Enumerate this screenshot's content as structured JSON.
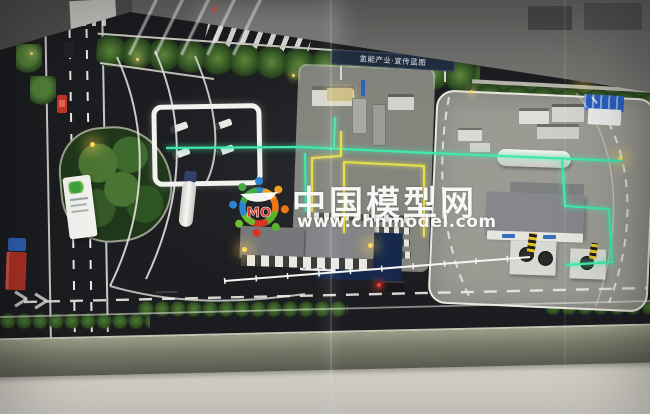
{
  "watermark": {
    "title": "中国模型网",
    "url": "www.chnmodel.com",
    "logo_text": "MO"
  },
  "signs": {
    "banner_text": "氢能产业·宣传蓝图"
  },
  "colors": {
    "led_green": "#3fe9ac",
    "led_yellow": "#e8e04a",
    "lamp_glow": "#ffd95e",
    "watermark_white": "#ffffff",
    "logo_red": "#d93320",
    "logo_blue": "#2e86d3",
    "logo_orange": "#f0a41e",
    "logo_green": "#57b32a",
    "blue_roof": "#2b5fc0",
    "truck_red": "#b23227",
    "truck_cab_blue": "#2f63b8",
    "asphalt": "#1c1d20",
    "pavement": "#9b9b94"
  }
}
